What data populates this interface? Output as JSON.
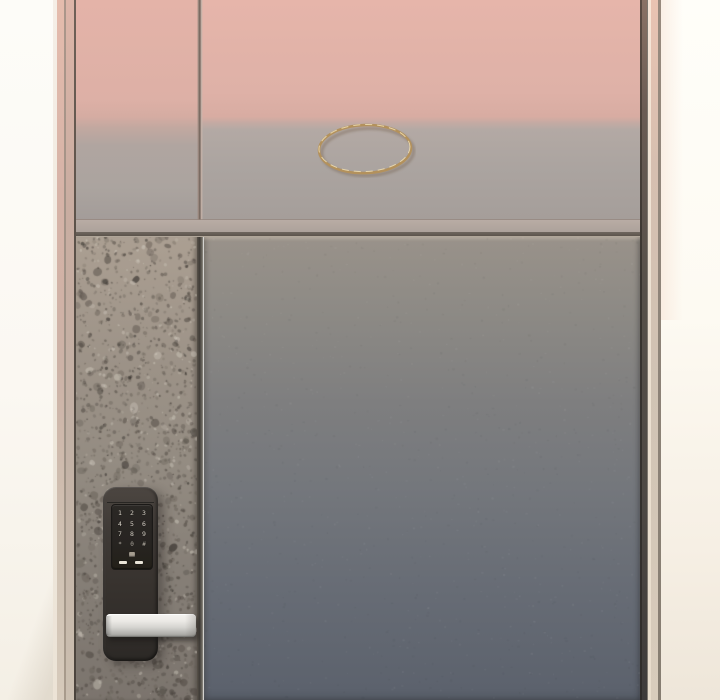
{
  "scene": {
    "type": "illustration",
    "subject": "apartment entrance door with digital keypad lock, sunset reflection on upper panels"
  },
  "palette": {
    "pink_top": "#e4b3a8",
    "pink_deep": "#d8aca2",
    "upper_gray": "#aba49f",
    "upper_gray_deep": "#a59e9a",
    "panel_top": "#99928a",
    "panel_mid": "#74777c",
    "panel_bottom": "#5b616c",
    "terrazzo_top": "#ab9f92",
    "terrazzo_mid": "#948c82",
    "terrazzo_bottom": "#7b746d",
    "speckle_dark": "#453f39",
    "speckle_mid": "#5f584f",
    "speckle_light": "#d2ccc0",
    "lock_body": "#3f3a36",
    "lock_body_dark": "#2c2926",
    "lock_plate": "#272421",
    "key_glyph": "#d9d3c8",
    "handle_light": "#f4f3f0",
    "handle_dark": "#989792",
    "ring_gold": "#b3915c",
    "ring_highlight": "#ecdcb0",
    "wall_left_top": "#fdfcf8",
    "wall_left_bottom": "#f4efe5",
    "wall_right_top": "#fffef9",
    "wall_right_bottom": "#eee6d9",
    "frame_pink": "#e5bcad",
    "frame_beige": "#d6cabb",
    "edge_dark": "#4e4944"
  },
  "lock": {
    "keypad_keys": [
      "1",
      "2",
      "3",
      "4",
      "5",
      "6",
      "7",
      "8",
      "9",
      "*",
      "0",
      "#"
    ],
    "indicator_dash_count": 2
  },
  "ring": {
    "shape": "ellipse",
    "finish": "brass"
  }
}
